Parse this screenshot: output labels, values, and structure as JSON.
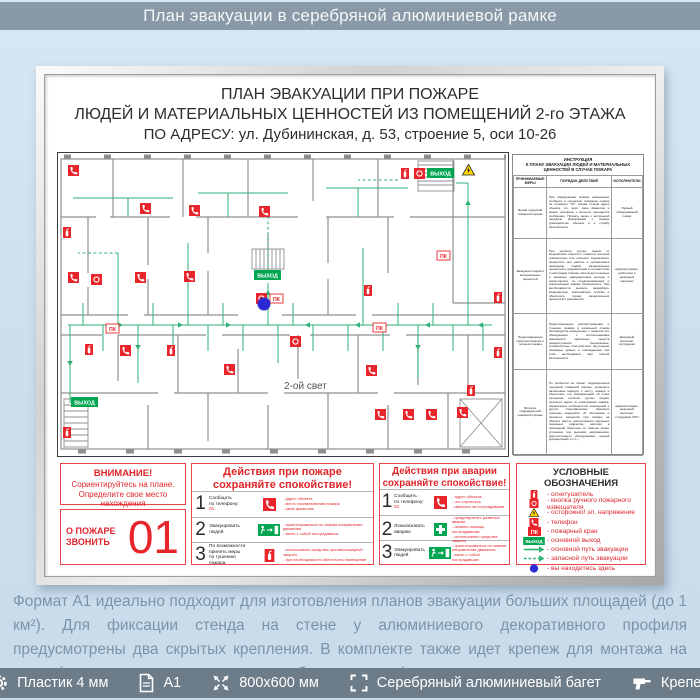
{
  "header": {
    "title": "План эвакуации в серебряной алюминиевой рамке"
  },
  "board": {
    "title_line1": "ПЛАН ЭВАКУАЦИИ ПРИ ПОЖАРЕ",
    "title_line2": "ЛЮДЕЙ И МАТЕРИАЛЬНЫХ ЦЕННОСТЕЙ ИЗ ПОМЕЩЕНИЙ 2-го ЭТАЖА",
    "title_line3": "ПО АДРЕСУ: ул. Дубининская, д. 53, строение 5, оси 10-26"
  },
  "plan": {
    "second_light_label": "2-ой свет",
    "exit_label": "ВЫХОД",
    "pk_label": "ПК",
    "markers": [
      {
        "t": "phone",
        "x": 10,
        "y": 12
      },
      {
        "t": "phone",
        "x": 82,
        "y": 50
      },
      {
        "t": "phone",
        "x": 131,
        "y": 52
      },
      {
        "t": "phone",
        "x": 201,
        "y": 53
      },
      {
        "t": "phone",
        "x": 10,
        "y": 119
      },
      {
        "t": "phone",
        "x": 77,
        "y": 119
      },
      {
        "t": "phone",
        "x": 126,
        "y": 118
      },
      {
        "t": "phone",
        "x": 62,
        "y": 192
      },
      {
        "t": "phone",
        "x": 166,
        "y": 211
      },
      {
        "t": "phone",
        "x": 308,
        "y": 212
      },
      {
        "t": "phone",
        "x": 317,
        "y": 256
      },
      {
        "t": "phone",
        "x": 345,
        "y": 256
      },
      {
        "t": "phone",
        "x": 368,
        "y": 256
      },
      {
        "t": "phone",
        "x": 399,
        "y": 254
      },
      {
        "t": "ext",
        "x": 343,
        "y": 15
      },
      {
        "t": "ext",
        "x": 306,
        "y": 132
      },
      {
        "t": "ext",
        "x": 409,
        "y": 232
      },
      {
        "t": "ext",
        "x": 27,
        "y": 191
      },
      {
        "t": "ext",
        "x": 109,
        "y": 192
      },
      {
        "t": "ext",
        "x": 5,
        "y": 74
      },
      {
        "t": "ext",
        "x": 5,
        "y": 274
      },
      {
        "t": "ext",
        "x": 436,
        "y": 139
      },
      {
        "t": "ext",
        "x": 436,
        "y": 194
      },
      {
        "t": "callpoint",
        "x": 356,
        "y": 15
      },
      {
        "t": "callpoint",
        "x": 33,
        "y": 121
      },
      {
        "t": "callpoint",
        "x": 198,
        "y": 140
      },
      {
        "t": "callpoint",
        "x": 232,
        "y": 183
      },
      {
        "t": "pk",
        "x": 212,
        "y": 141
      },
      {
        "t": "pk",
        "x": 48,
        "y": 171
      },
      {
        "t": "pk",
        "x": 379,
        "y": 98
      },
      {
        "t": "pk",
        "x": 315,
        "y": 170
      },
      {
        "t": "exit",
        "x": 369,
        "y": 15
      },
      {
        "t": "exit",
        "x": 196,
        "y": 117
      },
      {
        "t": "exit",
        "x": 13,
        "y": 244
      },
      {
        "t": "warning",
        "x": 404,
        "y": 11
      },
      {
        "t": "youarehere",
        "x": 206,
        "y": 151
      }
    ]
  },
  "instruction": {
    "title": "ИНСТРУКЦИЯ\nК ПЛАНУ ЭВАКУАЦИИ ЛЮДЕЙ И МАТЕРИАЛЬНЫХ ЦЕННОСТЕЙ В СЛУЧАЕ ПОЖАРА",
    "col_measure": "ПРИНИМАЕМЫЕ МЕРЫ",
    "col_action": "ПОРЯДОК ДЕЙСТВИЙ",
    "col_exec": "ИСПОЛНИТЕЛИ",
    "rows": [
      {
        "measure": "Вызов городской пожарной охраны",
        "action": "При обнаружении пожара немедленно сообщить в городскую пожарную охрану по телефону \"01\", указав точный адрес объекта, что горит, свою фамилию и номер телефона, с которого передается сообщение. Принять меры к экстренной передаче информации о пожаре руководителю объекта и в службу безопасности.",
        "exec": "Первый обнаруживший пожар"
      },
      {
        "measure": "Эвакуация людей и материальных ценностей",
        "action": "При наличии угрозы людям от воздействия открытого пламени, высокой температуры или сильного задымления, прекратить все работы и организовать эвакуацию людей, материальных ценностей и документации в соответствии с настоящим планом, используя основные и запасные эвакуационные выходы и ориентируясь по предписывающим и указательным знакам безопасности. При необходимости вызвать аварийную, медицинскую, милицейскую службы и обеспечить охрану материальных ценностей и документов.",
        "exec": "Администрация, работники и дежурный персонал"
      },
      {
        "measure": "Предотвращение распространения и тушение пожара",
        "action": "Предотвращение распространения и тушение пожара в начальной стадии производится немедленно с момента его обнаружения с использованием имеющихся первичных средств пожаротушения (порошковые, углекислотные огнетушители, внутренние пожарные краны) и соблюдением при этом необходимых мер личной безопасности.",
        "exec": "Дежурный персонал, сотрудники"
      },
      {
        "measure": "Встреча подразделений пожарной охраны",
        "action": "По прибытии на объект подразделения городской пожарной охраны, проводить начальника караула к месту пожара и обеспечить его информацией об очаге загорания, наличии угрозы людям, принятых мерах по локализации пожара, характерных особенностях помещений и других специфических, имеющих значение сведениях; об обстановке и принятых решениях при пожаре на объекте (месте расположения наружных пожарных гидрантов, наличии в помещении баллонов со сжатым газом, установок под высоким напряжением, дорогостоящего оборудования, ценной документации и т.п.).",
        "exec": "Администрация, дежурный персонал, сотрудники ЧОП"
      }
    ]
  },
  "attention": {
    "title": "ВНИМАНИЕ!",
    "line1": "Сориентируйтесь на плане.",
    "line2": "Определите свое место нахождения"
  },
  "call_fire": {
    "label": "О ПОЖАРЕ ЗВОНИТЬ",
    "number": "01"
  },
  "fire_actions": {
    "title1": "Действия при пожаре",
    "title2": "сохраняйте спокойствие!",
    "rows": [
      {
        "num": "1",
        "label": "Сообщить\nпо телефону:",
        "sub": "01",
        "icon": "phone",
        "notes": [
          "адрес объекта",
          "место возникновения пожара",
          "свою фамилию"
        ]
      },
      {
        "num": "2",
        "label": "Эвакуировать\nлюдей",
        "sub": "",
        "icon": "exit",
        "notes": [
          "ориентироваться по знакам направления движения",
          "взять с собой пострадавших"
        ]
      },
      {
        "num": "3",
        "label": "По возможности\nпринять меры\nпо тушению\nпожара",
        "sub": "",
        "icon": "extinguisher",
        "notes": [
          "использовать средства противопожарной защиты",
          "при необходимости обесточить помещение"
        ]
      }
    ]
  },
  "accident_actions": {
    "title1": "Действия при аварии",
    "title2": "сохраняйте спокойствие!",
    "rows": [
      {
        "num": "1",
        "label": "Сообщить\nпо телефону:",
        "sub": "01",
        "icon": "phone",
        "notes": [
          "адрес объекта",
          "что случилось",
          "имеются ли пострадавшие"
        ]
      },
      {
        "num": "2",
        "label": "Локализовать\nаварию",
        "sub": "",
        "icon": "cross",
        "notes": [
          "предотвратить развитие аварии",
          "оказать помощь пострадавшим",
          "использовать средства защиты"
        ]
      },
      {
        "num": "3",
        "label": "Эвакуировать\nлюдей",
        "sub": "",
        "icon": "exit",
        "notes": [
          "ориентироваться по знакам направления движения",
          "взять с собой пострадавших"
        ]
      }
    ]
  },
  "legend": {
    "title": "УСЛОВНЫЕ ОБОЗНАЧЕНИЯ",
    "items": [
      {
        "icon": "extinguisher",
        "label": "огнетушитель"
      },
      {
        "icon": "callpoint",
        "label": "кнопка ручного пожарного извещателя"
      },
      {
        "icon": "warning",
        "label": "осторожно! эл. напряжение"
      },
      {
        "icon": "phone",
        "label": "телефон"
      },
      {
        "icon": "hydrant",
        "label": "пожарный кран"
      },
      {
        "icon": "exitsign",
        "label": "основной выход"
      },
      {
        "icon": "route-main",
        "label": "основной путь эвакуации"
      },
      {
        "icon": "route-spare",
        "label": "запасной путь эвакуации"
      },
      {
        "icon": "youarehere",
        "label": "вы находитесь здесь"
      }
    ]
  },
  "description": "Формат А1 идеально подходит для изготовления планов эвакуации больших площадей (до 1 км²). Для фиксации стенда на стене у алюминиевого декоративного профиля предусмотрены два скрытых крепления. В комплекте также идет крепеж для монтажа на стене (подходит в т.ч. для кирпичных и бетонных стен)",
  "footer": {
    "items": [
      {
        "icon": "gear",
        "label": "Пластик 4 мм"
      },
      {
        "icon": "document",
        "label": "А1"
      },
      {
        "icon": "resize",
        "label": "800х600 мм"
      },
      {
        "icon": "frame",
        "label": "Серебряный алюминиевый багет"
      },
      {
        "icon": "drill",
        "label": "Крепеж"
      }
    ]
  },
  "colors": {
    "red": "#e8252a",
    "green": "#00a651",
    "route_green": "#2fb277",
    "blue_dot": "#2b2bd5",
    "warning_yellow": "#ffd800",
    "bar_top": "#8a99a7",
    "bar_bottom": "#6d7c89",
    "page_bg": "#cadeee"
  }
}
